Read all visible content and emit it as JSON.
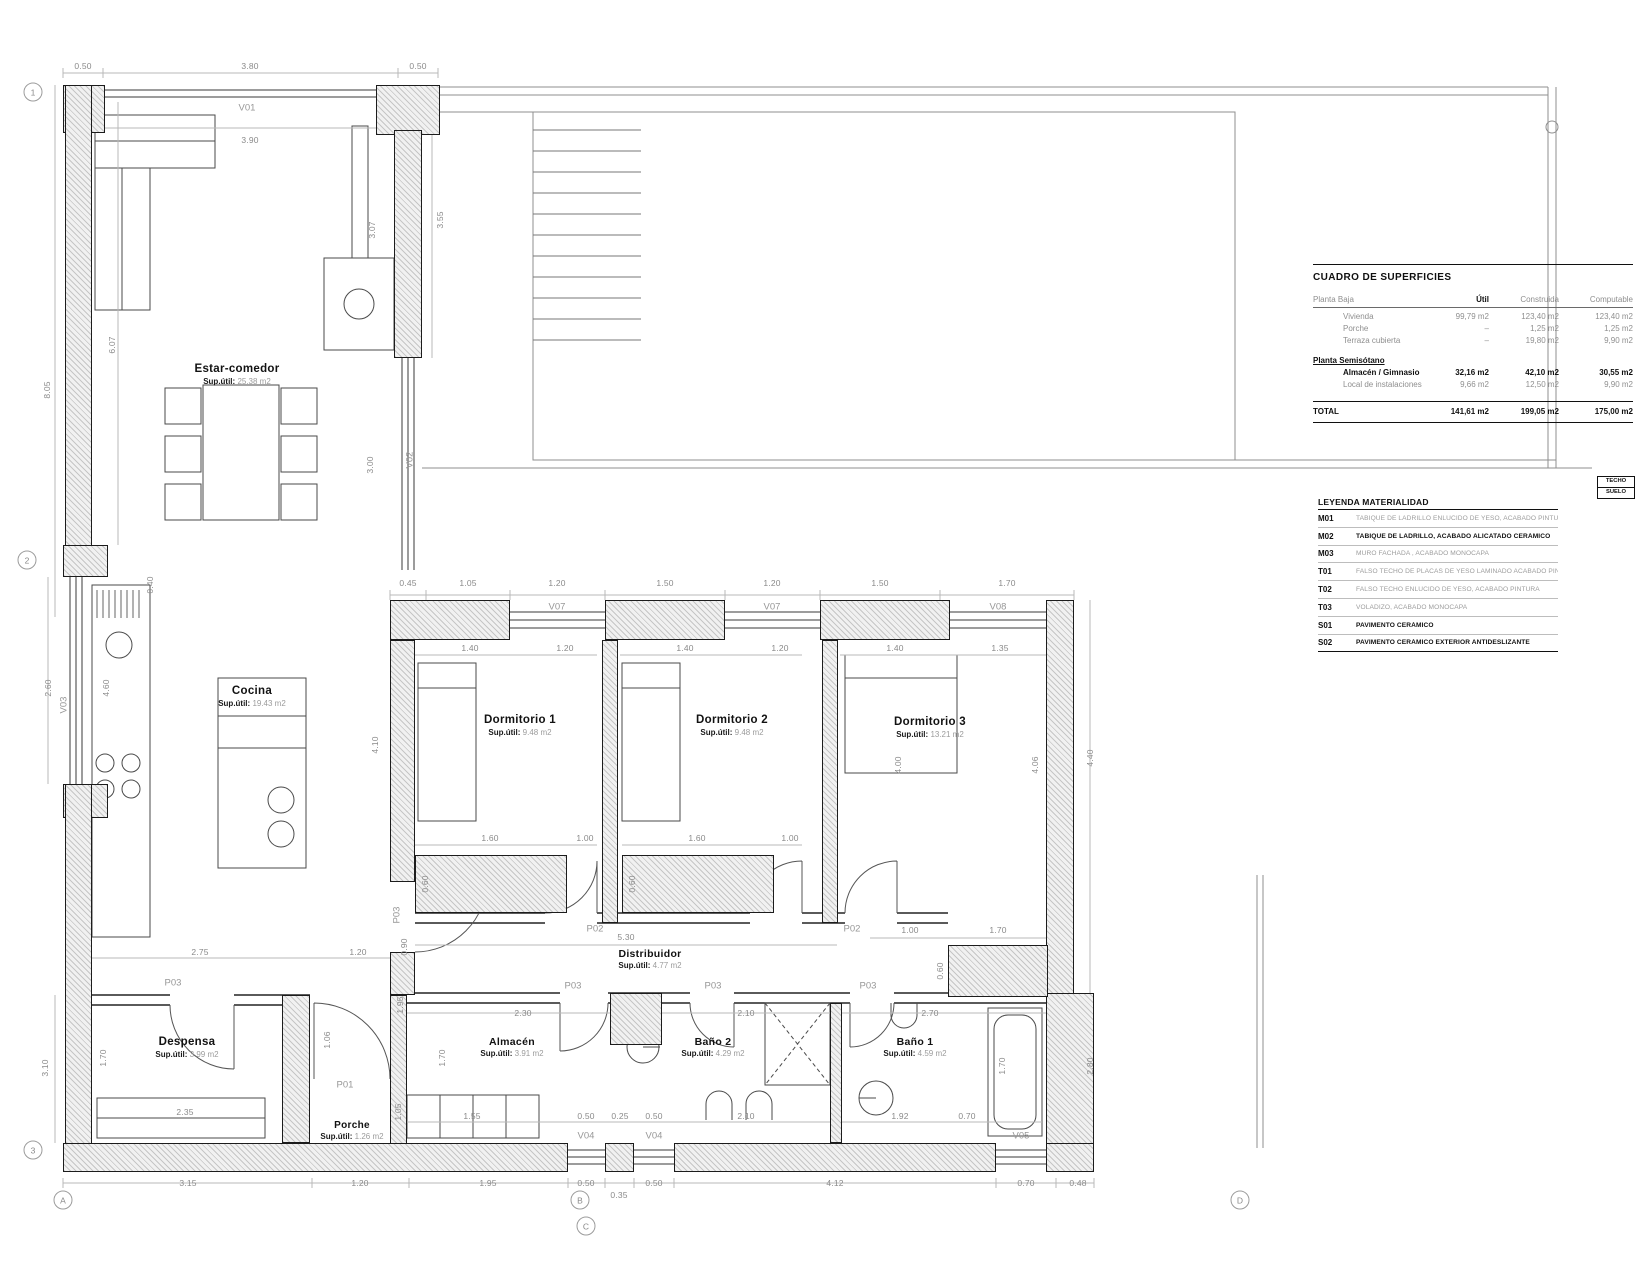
{
  "rooms": {
    "estar": {
      "name": "Estar-comedor",
      "sup_label": "Sup.útil:",
      "sup_value": "25.38 m2"
    },
    "cocina": {
      "name": "Cocina",
      "sup_label": "Sup.útil:",
      "sup_value": "19.43 m2"
    },
    "despensa": {
      "name": "Despensa",
      "sup_label": "Sup.útil:",
      "sup_value": "3.99 m2"
    },
    "porche": {
      "name": "Porche",
      "sup_label": "Sup.útil:",
      "sup_value": "1.26 m2"
    },
    "distribuidor": {
      "name": "Distribuidor",
      "sup_label": "Sup.útil:",
      "sup_value": "4.77 m2"
    },
    "dormitorio1": {
      "name": "Dormitorio 1",
      "sup_label": "Sup.útil:",
      "sup_value": "9.48 m2"
    },
    "dormitorio2": {
      "name": "Dormitorio 2",
      "sup_label": "Sup.útil:",
      "sup_value": "9.48 m2"
    },
    "dormitorio3": {
      "name": "Dormitorio 3",
      "sup_label": "Sup.útil:",
      "sup_value": "13.21 m2"
    },
    "almacen": {
      "name": "Almacén",
      "sup_label": "Sup.útil:",
      "sup_value": "3.91 m2"
    },
    "bano2": {
      "name": "Baño 2",
      "sup_label": "Sup.útil:",
      "sup_value": "4.29 m2"
    },
    "bano1": {
      "name": "Baño 1",
      "sup_label": "Sup.útil:",
      "sup_value": "4.59 m2"
    }
  },
  "doors": {
    "p01": "P01",
    "p02": "P02",
    "p03": "P03"
  },
  "windows": {
    "v01": "V01",
    "v02": "V02",
    "v03": "V03",
    "v04": "V04",
    "v05": "V05",
    "v07": "V07",
    "v08": "V08"
  },
  "dims": {
    "top": [
      "0.50",
      "3.80",
      "0.50"
    ],
    "top_inner": "3.90",
    "left_outer": "8.05",
    "left_inner": "6.07",
    "right_outer_top": "3.55",
    "right_inner_top": "3.07",
    "v02_h": "3.00",
    "wall_gap": "0.40",
    "kwin": "2.60",
    "kin": "4.60",
    "chain1": [
      "0.45",
      "1.05",
      "1.20",
      "1.50",
      "1.20",
      "1.50",
      "1.70"
    ],
    "chain2": [
      "1.40",
      "1.20",
      "1.40",
      "1.20",
      "1.40",
      "1.35"
    ],
    "d1depth": "4.10",
    "d3bed": "4.00",
    "d3depth": "4.06",
    "right_outer": "4.40",
    "w1": [
      "1.60",
      "1.00"
    ],
    "w2": [
      "1.60",
      "1.00"
    ],
    "w3": [
      "1.00",
      "1.70"
    ],
    "wd1": "0.60",
    "wd2": "0.60",
    "wd3": "0.60",
    "corr": "5.30",
    "corr_door": "0.90",
    "desp_chain": [
      "2.75",
      "1.20"
    ],
    "desp_w": "2.35",
    "desp_h": "1.70",
    "desp_out": "3.10",
    "porch_door": "1.06",
    "porch_d": "1.95",
    "porch_in": "1.05",
    "alm_top": "2.30",
    "alm_shelf": "1.55",
    "alm_h": "1.70",
    "boiler": [
      "0.50",
      "0.25",
      "0.50"
    ],
    "b2_top": "2.10",
    "b2_in": "2.10",
    "b1_top": "2.70",
    "b1_in": [
      "1.92",
      "0.70"
    ],
    "b1_h": "1.70",
    "right_low": "2.80",
    "bottom": [
      "3.15",
      "1.20",
      "1.95",
      "0.50",
      "0.35",
      "0.50",
      "4.12",
      "0.70",
      "0.48"
    ]
  },
  "grid": {
    "left": [
      "1",
      "2",
      "3"
    ],
    "bottom": [
      "A",
      "B",
      "C",
      "D"
    ]
  },
  "surface_table": {
    "title": "CUADRO DE SUPERFICIES",
    "col_headers": [
      "Planta Baja",
      "Útil",
      "Construida",
      "Computable"
    ],
    "planta_baja": [
      {
        "name": "Vivienda",
        "util": "99,79 m2",
        "construida": "123,40 m2",
        "computable": "123,40 m2"
      },
      {
        "name": "Porche",
        "util": "–",
        "construida": "1,25 m2",
        "computable": "1,25 m2"
      },
      {
        "name": "Terraza cubierta",
        "util": "–",
        "construida": "19,80 m2",
        "computable": "9,90 m2"
      }
    ],
    "section2_title": "Planta Semisótano",
    "semisotano": [
      {
        "name": "Almacén / Gimnasio",
        "util": "32,16 m2",
        "construida": "42,10 m2",
        "computable": "30,55 m2"
      },
      {
        "name": "Local de instalaciones",
        "util": "9,66 m2",
        "construida": "12,50 m2",
        "computable": "9,90 m2"
      }
    ],
    "total": {
      "label": "TOTAL",
      "util": "141,61 m2",
      "construida": "199,05 m2",
      "computable": "175,00 m2"
    }
  },
  "techo_suelo": {
    "top": "TECHO",
    "bottom": "SUELO"
  },
  "legend": {
    "title": "LEYENDA MATERIALIDAD",
    "items": [
      {
        "code": "M01",
        "desc": "TABIQUE DE LADRILLO ENLUCIDO DE YESO, ACABADO PINTURA"
      },
      {
        "code": "M02",
        "desc": "TABIQUE DE LADRILLO, ACABADO ALICATADO CERÁMICO"
      },
      {
        "code": "M03",
        "desc": "MURO FACHADA , ACABADO MONOCAPA"
      },
      {
        "code": "T01",
        "desc": "FALSO TECHO DE PLACAS DE YESO LAMINADO ACABADO PINTURA"
      },
      {
        "code": "T02",
        "desc": "FALSO TECHO ENLUCIDO DE YESO, ACABADO PINTURA"
      },
      {
        "code": "T03",
        "desc": "VOLADIZO,  ACABADO MONOCAPA"
      },
      {
        "code": "S01",
        "desc": "PAVIMENTO CERÁMICO"
      },
      {
        "code": "S02",
        "desc": "PAVIMENTO CERÁMICO EXTERIOR ANTIDESLIZANTE"
      }
    ]
  }
}
